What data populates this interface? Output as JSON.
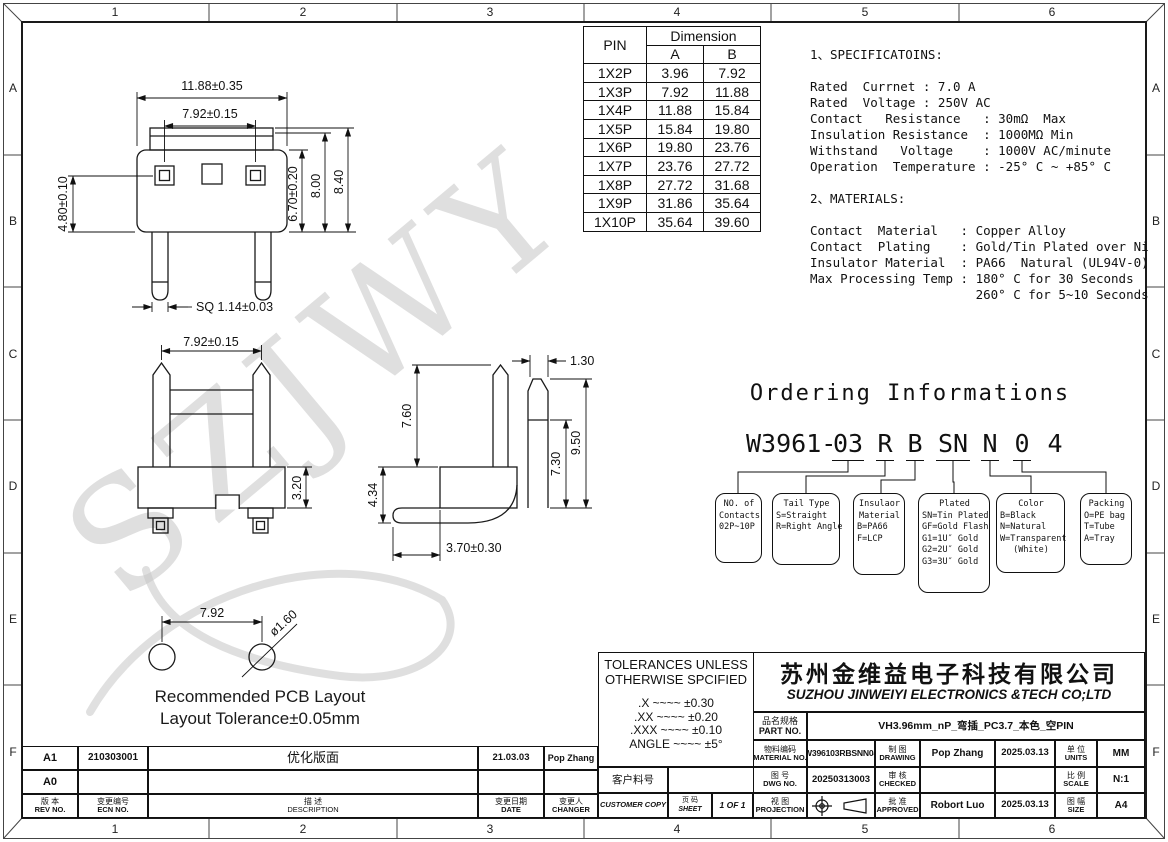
{
  "sheet": {
    "watermark": "SZJWY",
    "grid_cols": [
      "1",
      "2",
      "3",
      "4",
      "5",
      "6"
    ],
    "grid_rows": [
      "A",
      "B",
      "C",
      "D",
      "E",
      "F"
    ]
  },
  "pin_table": {
    "col_pin": "PIN",
    "col_dimension": "Dimension",
    "col_a": "A",
    "col_b": "B",
    "rows": [
      {
        "pin": "1X2P",
        "a": "3.96",
        "b": "7.92"
      },
      {
        "pin": "1X3P",
        "a": "7.92",
        "b": "11.88"
      },
      {
        "pin": "1X4P",
        "a": "11.88",
        "b": "15.84"
      },
      {
        "pin": "1X5P",
        "a": "15.84",
        "b": "19.80"
      },
      {
        "pin": "1X6P",
        "a": "19.80",
        "b": "23.76"
      },
      {
        "pin": "1X7P",
        "a": "23.76",
        "b": "27.72"
      },
      {
        "pin": "1X8P",
        "a": "27.72",
        "b": "31.68"
      },
      {
        "pin": "1X9P",
        "a": "31.86",
        "b": "35.64"
      },
      {
        "pin": "1X10P",
        "a": "35.64",
        "b": "39.60"
      }
    ]
  },
  "specifications": {
    "text": "1、SPECIFICATOINS:\n\nRated  Currnet : 7.0 A\nRated  Voltage : 250V AC\nContact   Resistance   : 30mΩ  Max\nInsulation Resistance  : 1000MΩ Min\nWithstand   Voltage    : 1000V AC/minute\nOperation  Temperature : -25° C ~ +85° C\n\n2、MATERIALS:\n\nContact  Material   : Copper Alloy\nContact  Plating    : Gold/Tin Plated over Ni\nInsulator Material  : PA66  Natural (UL94V-0)\nMax Processing Temp : 180° C for 30 Seconds\n                      260° C for 5~10 Seconds"
  },
  "ordering": {
    "title": "Ordering Informations",
    "code_prefix": "W3961-",
    "segments": [
      "03",
      "R",
      "B",
      "SN",
      "N",
      "0",
      "4"
    ],
    "boxes": [
      {
        "lines": [
          "NO. of",
          "Contacts",
          "02P~10P"
        ]
      },
      {
        "lines": [
          "Tail Type",
          "S=Straight",
          "R=Right Angle"
        ]
      },
      {
        "lines": [
          "Insulaor",
          "Material",
          "B=PA66",
          "F=LCP"
        ]
      },
      {
        "lines": [
          "Plated",
          "SN=Tin Plated",
          "GF=Gold Flash",
          "G1=1U″ Gold",
          "G2=2U″ Gold",
          "G3=3U″ Gold"
        ]
      },
      {
        "lines": [
          "Color",
          "B=Black",
          "N=Natural",
          "W=Transparent",
          "(White)"
        ]
      },
      {
        "lines": [
          "Packing",
          "O=PE bag",
          "T=Tube",
          "A=Tray"
        ]
      }
    ]
  },
  "dims_top": {
    "width_outer": "11.88±0.35",
    "width_inner": "7.92±0.15",
    "height_left": "4.80±0.10",
    "height_inner": "6.70±0.20",
    "height_mid": "8.00",
    "height_outer": "8.40",
    "pin_sq": "SQ 1.14±0.03"
  },
  "dims_front": {
    "pitch": "7.92±0.15",
    "body_h": "3.20"
  },
  "dims_side": {
    "pin_h": "7.60",
    "latch_w": "1.30",
    "h1": "7.30",
    "h2": "9.50",
    "h3": "4.34",
    "leg_offset": "3.70±0.30"
  },
  "pcb": {
    "pitch": "7.92",
    "hole": "ø1.60",
    "caption1": "Recommended PCB Layout",
    "caption2": "Layout Tolerance±0.05mm"
  },
  "tolerances": {
    "title1": "TOLERANCES UNLESS",
    "title2": "OTHERWISE SPCIFIED",
    "l1": ".X  ~~~~  ±0.30",
    "l2": ".XX  ~~~~  ±0.20",
    "l3": ".XXX  ~~~~  ±0.10",
    "l4": "ANGLE  ~~~~  ±5°"
  },
  "title_block": {
    "company_cn": "苏州金维益电子科技有限公司",
    "company_en": "SUZHOU JINWEIYI ELECTRONICS &TECH CO;LTD",
    "part_label_cn": "品名规格",
    "part_label_en": "PART NO.",
    "part_no": "VH3.96mm_nP_弯插_PC3.7_本色_空PIN",
    "material_label_cn": "物料编码",
    "material_label_en": "MATERIAL NO.",
    "material_no": "W396103RBSNN04",
    "drawing_label_cn": "制 图",
    "drawing_label_en": "DRAWING",
    "drawing_by": "Pop Zhang",
    "drawing_date": "2025.03.13",
    "units_label_cn": "单 位",
    "units_label_en": "UNITS",
    "units": "MM",
    "customer_label": "客户料号",
    "customer_no": "",
    "dwg_label_cn": "图 号",
    "dwg_label_en": "DWG NO.",
    "dwg_no": "20250313003",
    "checked_label_cn": "审 核",
    "checked_label_en": "CHECKED",
    "checked_by": "",
    "checked_date": "",
    "scale_label_cn": "比 例",
    "scale_label_en": "SCALE",
    "scale": "N:1",
    "copy_label": "CUSTOMER COPY",
    "sheet_label_cn": "页 码",
    "sheet_label_en": "SHEET",
    "sheet": "1 OF 1",
    "projection_label_cn": "视 图",
    "projection_label_en": "PROJECTION",
    "approved_label_cn": "批 准",
    "approved_label_en": "APPROVED",
    "approved_by": "Robort Luo",
    "approved_date": "2025.03.13",
    "size_label_cn": "图 幅",
    "size_label_en": "SIZE",
    "size": "A4"
  },
  "revision_table": {
    "header": {
      "rev_cn": "版 本",
      "rev_en": "REV NO.",
      "ecn_cn": "变更编号",
      "ecn_en": "ECN NO.",
      "desc_cn": "描 述",
      "desc_en": "DESCRIPTION",
      "date_cn": "变更日期",
      "date_en": "DATE",
      "changer_cn": "变更人",
      "changer_en": "CHANGER"
    },
    "rows": [
      {
        "rev": "A1",
        "ecn": "210303001",
        "desc": "优化版面",
        "date": "21.03.03",
        "changer": "Pop Zhang"
      },
      {
        "rev": "A0",
        "ecn": "",
        "desc": "",
        "date": "",
        "changer": ""
      }
    ]
  }
}
